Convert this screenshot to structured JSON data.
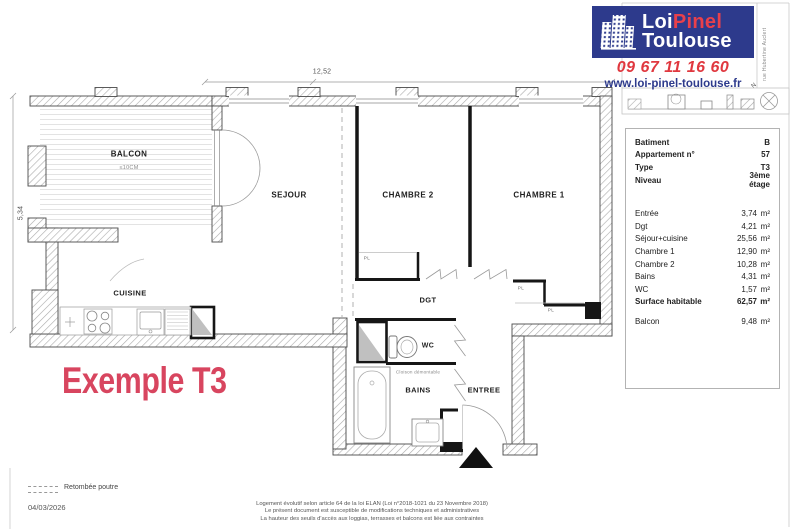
{
  "brand": {
    "name_part1": "Loi",
    "name_part2": "Pinel",
    "name_part3": "Toulouse",
    "phone": "09 67 11 16 60",
    "website": "www.loi-pinel-toulouse.fr",
    "color_blue": "#2D3A8C",
    "color_red": "#E23A44"
  },
  "title": {
    "text": "Exemple T3",
    "color": "#D8455F"
  },
  "compass": {
    "north": "N"
  },
  "street_label": "rue Hubertine Auclert",
  "dimensions": {
    "top": "12,52",
    "left": "5,34"
  },
  "rooms": {
    "balcon": "BALCON",
    "balcon_note": "≤10CM",
    "sejour": "SEJOUR",
    "chambre2": "CHAMBRE 2",
    "chambre1": "CHAMBRE 1",
    "cuisine": "CUISINE",
    "dgt": "DGT",
    "wc": "WC",
    "bains": "BAINS",
    "entree": "ENTREE",
    "placard": "PL",
    "cloison_note": "Cloison démontable"
  },
  "info_panel": {
    "meta": [
      {
        "label": "Batiment",
        "value": "B"
      },
      {
        "label": "Appartement n°",
        "value": "57"
      },
      {
        "label": "Type",
        "value": "T3"
      },
      {
        "label": "Niveau",
        "value": "3ème étage"
      }
    ],
    "areas": [
      {
        "label": "Entrée",
        "value": "3,74",
        "unit": "m²"
      },
      {
        "label": "Dgt",
        "value": "4,21",
        "unit": "m²"
      },
      {
        "label": "Séjour+cuisine",
        "value": "25,56",
        "unit": "m²"
      },
      {
        "label": "Chambre 1",
        "value": "12,90",
        "unit": "m²"
      },
      {
        "label": "Chambre 2",
        "value": "10,28",
        "unit": "m²"
      },
      {
        "label": "Bains",
        "value": "4,31",
        "unit": "m²"
      },
      {
        "label": "WC",
        "value": "1,57",
        "unit": "m²"
      }
    ],
    "total": {
      "label": "Surface habitable",
      "value": "62,57",
      "unit": "m²"
    },
    "balcony": {
      "label": "Balcon",
      "value": "9,48",
      "unit": "m²"
    }
  },
  "footer": {
    "legend_label": "Retombée poutre",
    "date": "04/03/2026",
    "disclaimer": [
      "Logement évolutif selon article 64 de la loi ELAN (Loi n°2018-1021 du 23 Novembre 2018)",
      "Le présent document est susceptible de modifications techniques et administratives",
      "La hauteur des seuils d'accès aux loggias, terrasses et balcons est liée aux contraintes"
    ]
  }
}
